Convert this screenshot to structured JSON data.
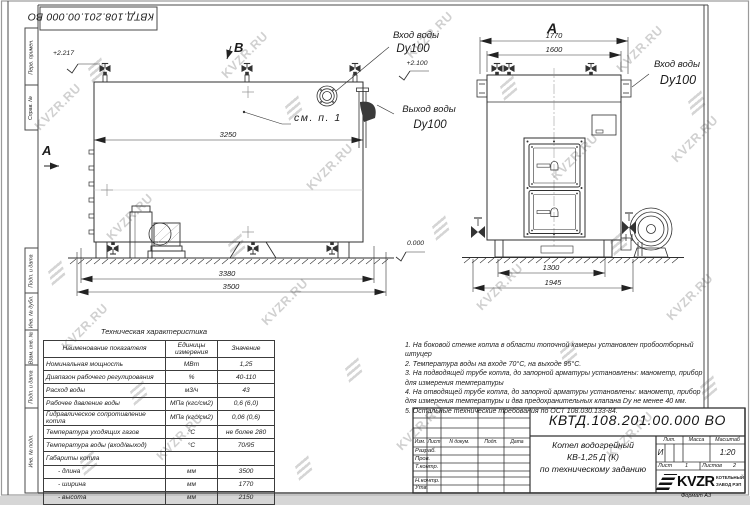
{
  "watermark": {
    "text": "KVZR.RU"
  },
  "stamp_top": {
    "designation": "КВТД.108.201.00.000  ВО"
  },
  "frame_labels": {
    "col1": "Перв. примен.",
    "col2": "Справ. №",
    "col3": "Подп. и дата",
    "col4": "Инв. № дубл.",
    "col5": "Взам. инв. №",
    "col6": "Подп. и дата",
    "col7": "Инв. № подл."
  },
  "side_view": {
    "marker_a": "A",
    "marker_b": "B",
    "dim_top": "3250",
    "dim_bottom_inner": "3380",
    "dim_bottom_outer": "3500",
    "elev_top": "+2.217",
    "see_note": "см. п. 1",
    "label_inlet": "Вход воды",
    "label_inlet_dn": "Dy100",
    "elev_inlet": "+2.100",
    "label_outlet": "Выход воды",
    "label_outlet_dn": "Dy100",
    "elev_ground": "0.000"
  },
  "front_view": {
    "title": "A",
    "dim_top_outer": "1770",
    "dim_top_inner": "1600",
    "dim_bottom_inner": "1300",
    "dim_bottom_outer": "1945",
    "label_inlet": "Вход воды",
    "label_inlet_dn": "Dy100"
  },
  "tech_table": {
    "title": "Техническая характеристика",
    "headers": {
      "name": "Наименование показателя",
      "units": "Единицы измерения",
      "value": "Значение"
    },
    "rows": [
      {
        "name": "Номинальная мощность",
        "units": "МВт",
        "value": "1,25"
      },
      {
        "name": "Диапазон рабочего регулирования",
        "units": "%",
        "value": "40-110"
      },
      {
        "name": "Расход воды",
        "units": "м3/ч",
        "value": "43"
      },
      {
        "name": "Рабочее давление воды",
        "units": "МПа (кгс/см2)",
        "value": "0,6 (6,0)"
      },
      {
        "name": "Гидравлическое сопротивление котла",
        "units": "МПа (кгс/см2)",
        "value": "0,06 (0,6)"
      },
      {
        "name": "Температура уходящих газов",
        "units": "°С",
        "value": "не более 280"
      },
      {
        "name": "Температура воды (вход/выход)",
        "units": "°С",
        "value": "70/95"
      },
      {
        "name": "Габариты котла",
        "units": "",
        "value": ""
      },
      {
        "name": "- длина",
        "units": "мм",
        "value": "3500"
      },
      {
        "name": "- ширина",
        "units": "мм",
        "value": "1770"
      },
      {
        "name": "- высота",
        "units": "мм",
        "value": "2150"
      }
    ]
  },
  "notes": [
    "1. На боковой стенке котла в области топочной камеры установлен пробоотборный штуцер",
    "2. Температура воды на входе 70°С, на выходе 95°С.",
    "3. На подводящей трубе котла, до запорной арматуры установлены: манометр, прибор для измерения температуры",
    "4. На отводящей трубе котла, до запорной арматуры установлены: манометр, прибор для измерения температуры и два предохранительных клапана Dy не менее 40 мм.",
    "5. Остальные технические требования по ОСТ 108.030.133-84."
  ],
  "title_block": {
    "designation": "КВТД.108.201.00.000  ВО",
    "col_izm": "Изм.",
    "col_list": "Лист",
    "col_ndoc": "N докум.",
    "col_podp": "Подп.",
    "col_data": "Дата",
    "row_razrab": "Разраб.",
    "row_prov": "Пров.",
    "row_tkontr": "Т.контр.",
    "row_nkontr": "Н.контр.",
    "row_utv": "Утв.",
    "name_line1": "Котел водогрейный",
    "name_line2": "КВ-1,25 Д (К)",
    "name_line3": "по техническому заданию",
    "lit_header": "Лит.",
    "massa_header": "Масса",
    "masshtab_header": "Масштаб",
    "lit_value": "И",
    "scale": "1:20",
    "sheet_label": "Лист",
    "sheet_number": "1",
    "sheets_label": "Листов",
    "sheets_total": "2",
    "logo_text": "KVZR",
    "logo_sub1": "КОТЕЛЬНЫЙ",
    "logo_sub2": "ЗАВОД РЭП",
    "format_label": "Формат  А3"
  }
}
